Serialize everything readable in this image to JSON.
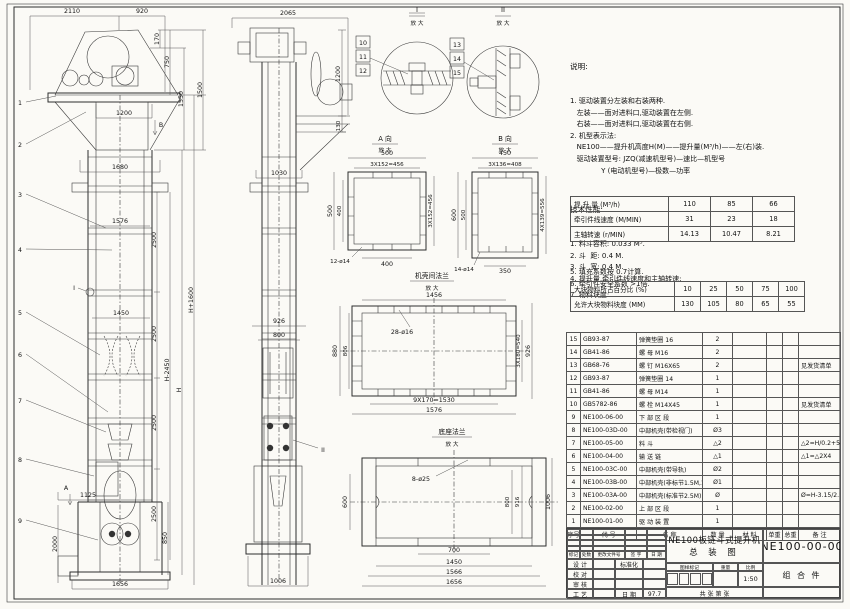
{
  "notes": {
    "heading": "说明:",
    "lines": [
      "1. 驱动装置分左装和右装两种.",
      "   左装——面对进料口,驱动装置在左侧.",
      "   右装——面对进料口,驱动装置在右侧.",
      "2. 机型表示法:",
      "   NE100——提升机高度H(M)——提升量(M³/h)——左(右)装.",
      "   驱动装置型号: JZQ(减速机型号)—速比—机型号",
      "              Y (电动机型号)—极数—功率"
    ],
    "tech_heading": "技术性能:",
    "tech_lines": [
      "1. 料斗容积: 0.033 M³.",
      "2. 斗  距: 0.4 M.",
      "3. 斗  宽: 0.4 M.",
      "4. 提升量,牵引件线速度和主轴转速:"
    ],
    "post_lines": [
      "5. 填充系数按 0.7计算.",
      "6. 牵引件安全系数 >1倍.",
      "7. 物料块度:"
    ]
  },
  "spec_table": {
    "rows": [
      {
        "label": "提 升 量  (M³/h)",
        "values": [
          "110",
          "85",
          "66"
        ]
      },
      {
        "label": "牵引件线速度 (M/MIN)",
        "values": [
          "31",
          "23",
          "18"
        ]
      },
      {
        "label": "主轴转速  (r/MIN)",
        "values": [
          "14.13",
          "10.47",
          "8.21"
        ]
      }
    ]
  },
  "lump_table": {
    "rows": [
      {
        "label": "大块物料所占百分比 (%)",
        "values": [
          "10",
          "25",
          "50",
          "75",
          "100"
        ]
      },
      {
        "label": "允许大块物料块度 (MM)",
        "values": [
          "130",
          "105",
          "80",
          "65",
          "55"
        ]
      }
    ]
  },
  "bom": {
    "headers": [
      "序号",
      "代  号",
      "名    称",
      "数 量",
      "材  料",
      "单重",
      "总重",
      "备  注"
    ],
    "rows": [
      [
        "15",
        "GB93-87",
        "弹簧垫圈 16",
        "2",
        "",
        "",
        "",
        ""
      ],
      [
        "14",
        "GB41-86",
        "螺  母 M16",
        "2",
        "",
        "",
        "",
        ""
      ],
      [
        "13",
        "GB68-76",
        "螺  钉 M16X65",
        "2",
        "",
        "",
        "",
        "见发货清单"
      ],
      [
        "12",
        "GB93-87",
        "弹簧垫圈 14",
        "1",
        "",
        "",
        "",
        ""
      ],
      [
        "11",
        "GB41-86",
        "螺  母 M14",
        "1",
        "",
        "",
        "",
        ""
      ],
      [
        "10",
        "GB5782-86",
        "螺  栓 M14X45",
        "1",
        "",
        "",
        "",
        "见发货清单"
      ],
      [
        "9",
        "NE100-06-00",
        "下 部 区 段",
        "1",
        "",
        "",
        "",
        ""
      ],
      [
        "8",
        "NE100-03D-00",
        "中部机壳(带检视门)",
        "Ø3",
        "",
        "",
        "",
        ""
      ],
      [
        "7",
        "NE100-05-00",
        "料  斗",
        "△2",
        "",
        "",
        "",
        "△2=H/0.2+5.75"
      ],
      [
        "6",
        "NE100-04-00",
        "输 送 链",
        "△1",
        "",
        "",
        "",
        "△1=△2X4"
      ],
      [
        "5",
        "NE100-03C-00",
        "中部机壳(带导轨)",
        "Ø2",
        "",
        "",
        "",
        ""
      ],
      [
        "4",
        "NE100-03B-00",
        "中部机壳(非标节1.5M,1M)",
        "Ø1",
        "",
        "",
        "",
        ""
      ],
      [
        "3",
        "NE100-03A-00",
        "中部机壳(标准节2.5M)",
        "Ø",
        "",
        "",
        "",
        "Ø=H-3.15/2.5"
      ],
      [
        "2",
        "NE100-02-00",
        "上 部 区 段",
        "1",
        "",
        "",
        "",
        ""
      ],
      [
        "1",
        "NE100-01-00",
        "驱 动 装 置",
        "1",
        "",
        "",
        "",
        ""
      ]
    ]
  },
  "title_block": {
    "product_title": "NE100板链斗式提升机",
    "drawing_type": "总  装  图",
    "drawing_no": "NE100-00-00",
    "assembly": "组 合 件",
    "rev_headers": [
      "标记",
      "处数",
      "更改文件号",
      "签 字",
      "日 期"
    ],
    "roles": [
      "设 计",
      "校 对",
      "审 核",
      "工 艺"
    ],
    "std_label": "标准化",
    "date_label": "日 期",
    "date_value": "97.7",
    "mark_label": "图样标记",
    "weight_label": "重量",
    "scale_label": "比例",
    "scale_value": "1:50",
    "sheet_label": "共  张 第  张"
  },
  "views": {
    "front": {
      "balloons": [
        "1",
        "2",
        "3",
        "4",
        "5",
        "6",
        "7",
        "8",
        "9"
      ],
      "marker_A": "A",
      "marker_B": "B",
      "marker_I": "I",
      "d2110": "2110",
      "d920": "920",
      "d170": "170",
      "d750": "750",
      "d1350": "1350",
      "d1500": "1500",
      "d1200": "1200",
      "d1680": "1680",
      "d2500": "2500",
      "d1576": "1576",
      "d1450": "1450",
      "dH2450": "H-2450",
      "dH": "H",
      "dH1600": "H+1600",
      "d1125": "1125",
      "d2000": "2000",
      "d850": "850",
      "d1656": "1656"
    },
    "side": {
      "marker_II": "II",
      "d2065": "2065",
      "d1200": "1200",
      "d130": "130",
      "d1030": "1030",
      "d926": "926",
      "d800": "800",
      "d1006": "1006"
    },
    "detail1": {
      "label": "I",
      "sub": "放 大",
      "items": [
        "10",
        "11",
        "12"
      ]
    },
    "detail2": {
      "label": "II",
      "sub": "放 大",
      "items": [
        "13",
        "14",
        "15"
      ]
    },
    "viewA": {
      "title": "A 向",
      "sub": "放 大",
      "top": "500",
      "top2": "3X152=456",
      "left": "500",
      "left2": "400",
      "right": "3X152=456",
      "bottom": "400",
      "holes": "12-ø14"
    },
    "viewB": {
      "title": "B 向",
      "sub": "放 大",
      "top": "450",
      "top2": "3X136=408",
      "left": "600",
      "left2": "500",
      "right": "4X139=556",
      "bottom": "350",
      "holes": "14-ø14"
    },
    "flange": {
      "title": "机壳间法兰",
      "sub": "放 大",
      "top": "1456",
      "holes": "28-ø16",
      "left": "880",
      "left2": "806",
      "right": "3X180=540",
      "right2": "926",
      "bottom": "9X170=1530",
      "bottom2": "1576"
    },
    "base": {
      "title": "底座法兰",
      "sub": "放 大",
      "holes": "8-ø25",
      "left": "600",
      "right": "800",
      "right2": "916",
      "right3": "1006",
      "bottom": "700",
      "bottom2": "1450",
      "bottom3": "1566",
      "bottom4": "1656"
    }
  }
}
